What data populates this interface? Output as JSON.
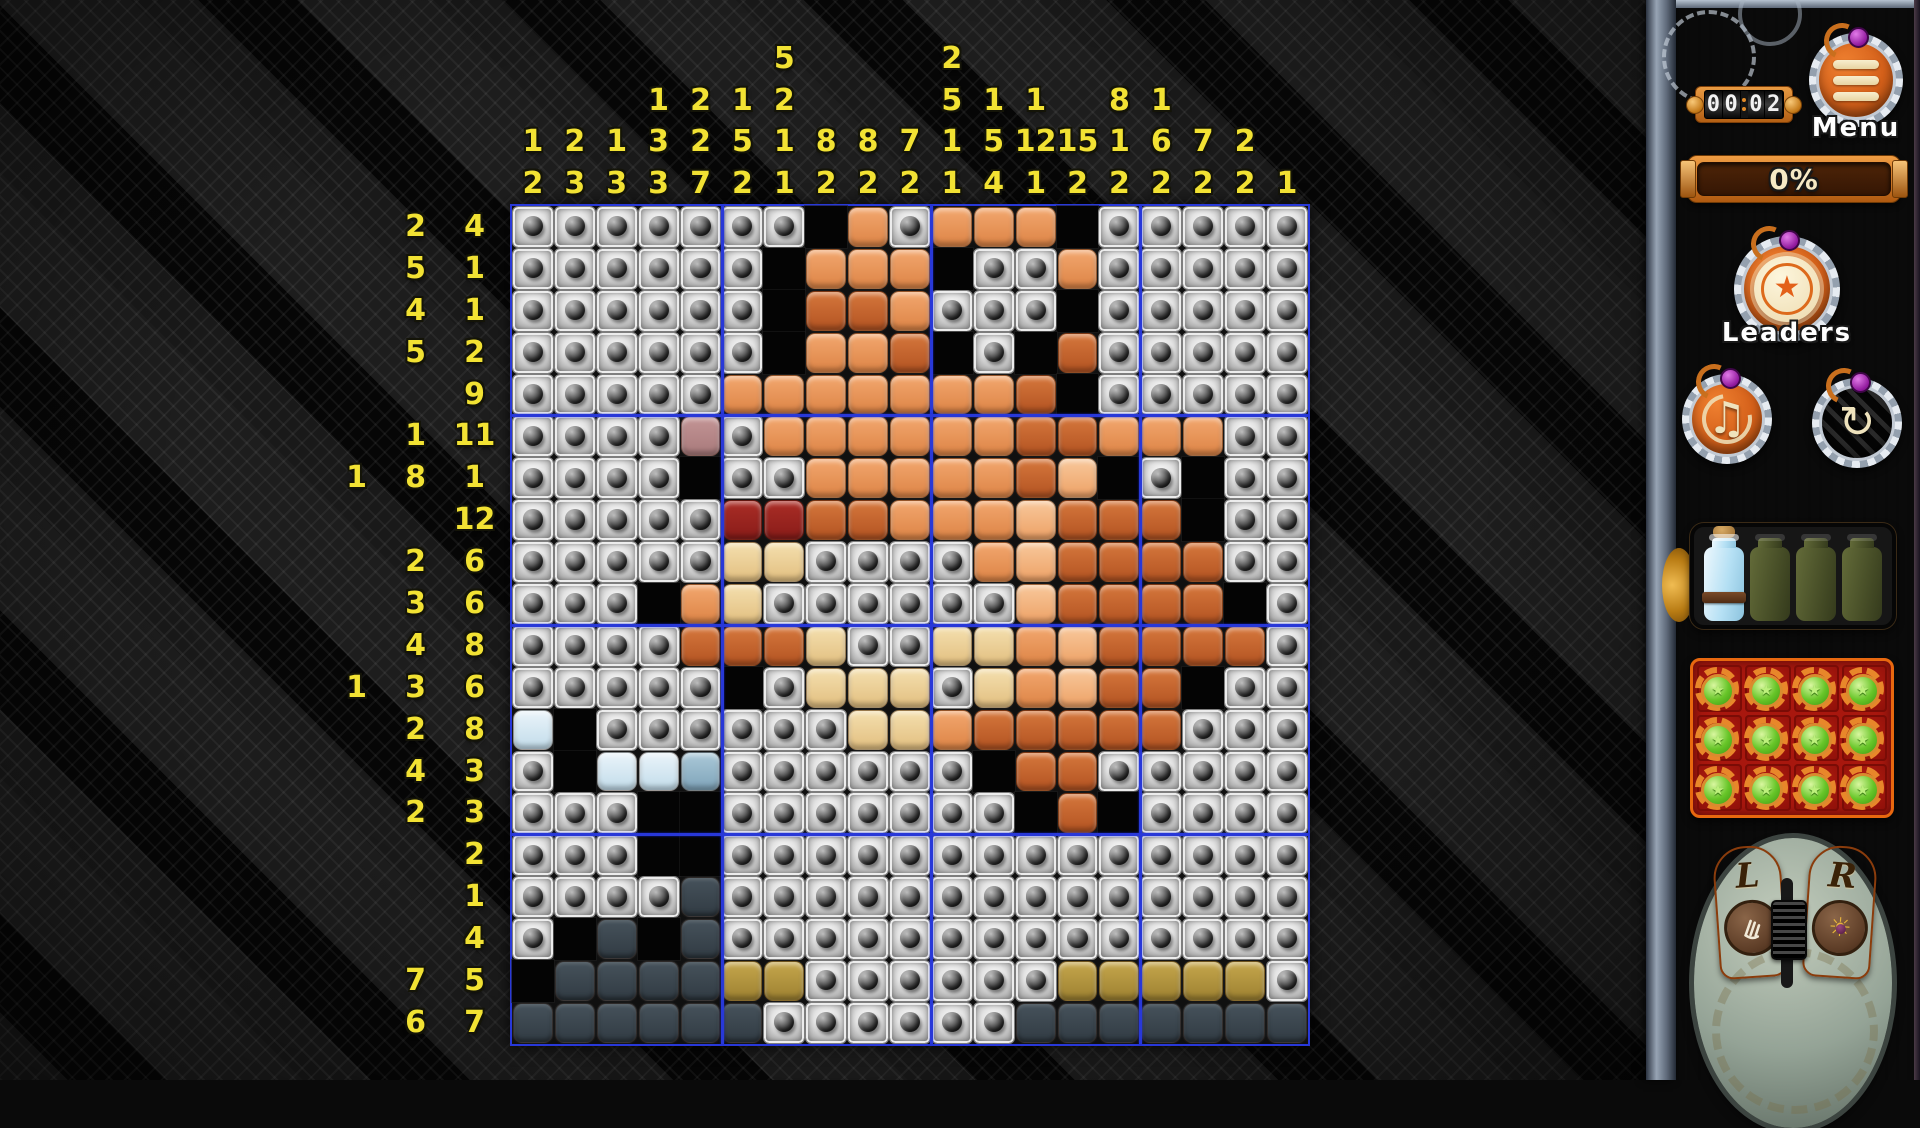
{
  "board": {
    "cols": 19,
    "rows": 20,
    "clue_color": "#f2e233",
    "separator_color": "#2838d8",
    "col_clues": [
      [
        1,
        2
      ],
      [
        2,
        3
      ],
      [
        1,
        3
      ],
      [
        1,
        3,
        3
      ],
      [
        2,
        2,
        7
      ],
      [
        1,
        5,
        2
      ],
      [
        5,
        2,
        1,
        1
      ],
      [
        8,
        2
      ],
      [
        8,
        2
      ],
      [
        7,
        2
      ],
      [
        2,
        5,
        1,
        1
      ],
      [
        1,
        5,
        4
      ],
      [
        1,
        12,
        1
      ],
      [
        15,
        2
      ],
      [
        8,
        1,
        2
      ],
      [
        1,
        6,
        2
      ],
      [
        7,
        2
      ],
      [
        2,
        2
      ],
      [
        1
      ]
    ],
    "row_clues": [
      [
        2,
        4
      ],
      [
        5,
        1
      ],
      [
        4,
        1
      ],
      [
        5,
        2
      ],
      [
        9
      ],
      [
        1,
        11
      ],
      [
        1,
        8,
        1
      ],
      [
        12
      ],
      [
        2,
        6
      ],
      [
        3,
        6
      ],
      [
        4,
        8
      ],
      [
        1,
        3,
        6
      ],
      [
        2,
        8
      ],
      [
        4,
        3
      ],
      [
        2,
        3
      ],
      [
        2
      ],
      [
        1
      ],
      [
        4
      ],
      [
        7,
        5
      ],
      [
        6,
        7
      ]
    ],
    "cells": [
      "UUUUUUUBOUOOOBUUUUU",
      "UUUUUUBOOOBUUOUUUUU",
      "UUUUUUBDDOUUUBUUUUU",
      "UUUUUUBOODBUBDUUUUU",
      "UUUUUOOOOOOODBUUUUU",
      "UUUUMUOOOOOODDOOOUU",
      "UUUUBUUOOOOODPBUBUU",
      "UUUUURRDDOOOPDDDBUU",
      "UUUUUCCUUUUOPDDDDUU",
      "UUUBOCUUUUUUPDDDDBU",
      "UUUUDDDCUUCCOPDDDDU",
      "UUUUUBUCCCUCOPDDBUU",
      "LBUUUUUUCCODDDDDUUU",
      "UBLLTUUUUUUBDDUUUUU",
      "UUUBBUUUUUUUBDBUUUU",
      "UUUBBUUUUUUUUUUUUUU",
      "UUUUSUUUUUUUUUUUUUU",
      "UBSBSUUUUUUUUUUUUUU",
      "BSSSSYYUUUUUUYYYYYU",
      "SSSSSSUUUUUUSSSSSSS"
    ],
    "legend": {
      "U": "unfilled-button",
      "B": "black #040404",
      "O": "orange #e2915a",
      "P": "peach #f2b384",
      "D": "rust #c4662f",
      "R": "dark-red #9c2423",
      "C": "cream #ecd3a2",
      "Y": "olive #b2953e",
      "S": "dark-slate #3a444c",
      "L": "light-blue #cfe5f0",
      "T": "steel-blue #8fb5c9",
      "M": "mauve #b98384"
    }
  },
  "sidebar": {
    "timer": {
      "digits": [
        "0",
        "0",
        "0",
        "2"
      ],
      "value_shown": "00:02"
    },
    "menu": {
      "label": "Menu",
      "icon": "hamburger-bars"
    },
    "progress": {
      "value": "0%"
    },
    "leaders": {
      "label": "Leaders",
      "icon": "star-rosette"
    },
    "music_button": {
      "icon": "music-note-circular-arrows",
      "glyph": "♫"
    },
    "restart_button": {
      "icon": "circular-arrows",
      "glyph": "↻"
    },
    "potions": {
      "slots": [
        "full",
        "empty",
        "empty",
        "empty"
      ],
      "filled": 1,
      "total": 4
    },
    "gear_tokens": {
      "rows": 3,
      "cols": 4,
      "total": 12,
      "icon": "gear-with-green-gem",
      "star_glyph": "★"
    },
    "mouse_toggle": {
      "left_label": "L",
      "right_label": "R",
      "right_icon_glyph": "☀"
    },
    "accent_orange": "#d4601a",
    "wood_brown": "#6b3a1f",
    "wood_maroon": "#472236"
  }
}
